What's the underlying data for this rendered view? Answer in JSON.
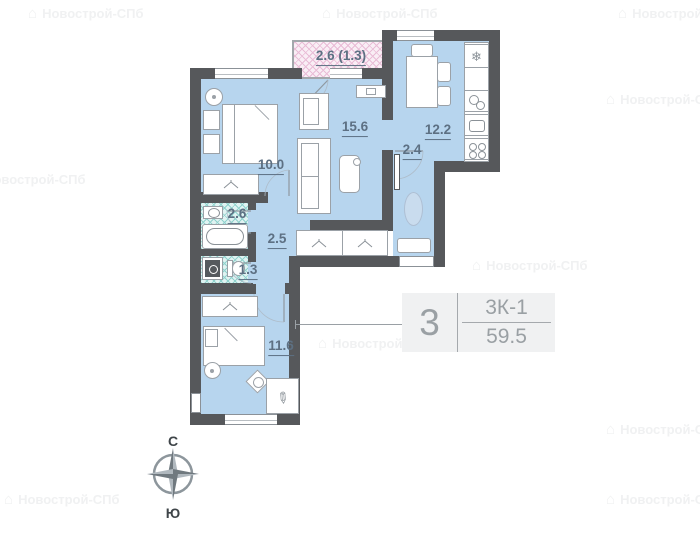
{
  "watermark": {
    "text": "Новострой-СПб",
    "building_glyph": "⌂"
  },
  "rooms": {
    "balcony": {
      "label": "2.6 (1.3)"
    },
    "living": {
      "label": "15.6"
    },
    "kitchen": {
      "label": "12.2"
    },
    "bedroom1": {
      "label": "10.0"
    },
    "hall": {
      "label": "2.4"
    },
    "bathroom": {
      "label": "2.6"
    },
    "corridor": {
      "label": "2.5"
    },
    "wc": {
      "label": "1.3"
    },
    "bedroom2": {
      "label": "11.6"
    }
  },
  "info_box": {
    "rooms_count": "3",
    "plan_type": "3К-1",
    "area": "59.5"
  },
  "compass": {
    "north_label": "С",
    "south_label": "Ю"
  },
  "icons": {
    "fridge": "❄",
    "pens": "✎"
  },
  "colors": {
    "wall": "#56585b",
    "floor": "#b7d5ee",
    "bath_hatch": "#8fd2cd",
    "balcony_hatch": "#e9bcd6",
    "label": "#5d7083"
  }
}
